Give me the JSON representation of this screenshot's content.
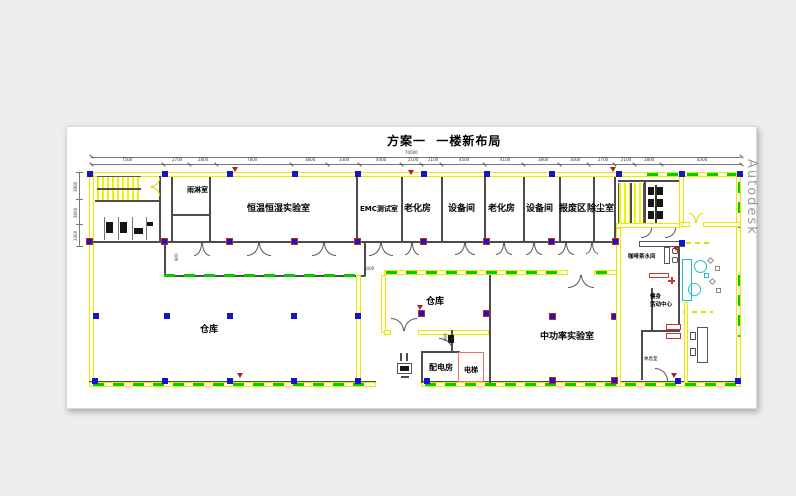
{
  "title": "方案一  一楼新布局",
  "watermark": "Autodesk",
  "rooms": {
    "rain_room": "雨淋室",
    "climate_lab": "恒温恒湿实验室",
    "emc_lab": "EMC测试室",
    "aging_room_1": "老化房",
    "equipment_room_1": "设备间",
    "aging_room_2": "老化房",
    "equipment_room_2": "设备间",
    "scrap_area": "报废区",
    "dust_removal": "除尘室",
    "warehouse_main": "仓库",
    "warehouse_small": "仓库",
    "mid_power_lab": "中功率实验室",
    "power_room": "配电房",
    "elevator": "电梯",
    "coffee_pantry": "咖啡茶水间",
    "fitness_line1": "健身",
    "fitness_line2": "活动中心",
    "lounge": "休息室"
  },
  "dimensions": {
    "top_total": "70000",
    "top": [
      "7500",
      "2700",
      "2800",
      "7800",
      "3800",
      "3300",
      "4400",
      "2100",
      "2100",
      "4500",
      "4100",
      "3800",
      "3000",
      "2700",
      "2100",
      "2800",
      "8300"
    ],
    "left": [
      "3900",
      "3600",
      "3300"
    ],
    "inner": [
      "900",
      "3000",
      "900"
    ]
  }
}
